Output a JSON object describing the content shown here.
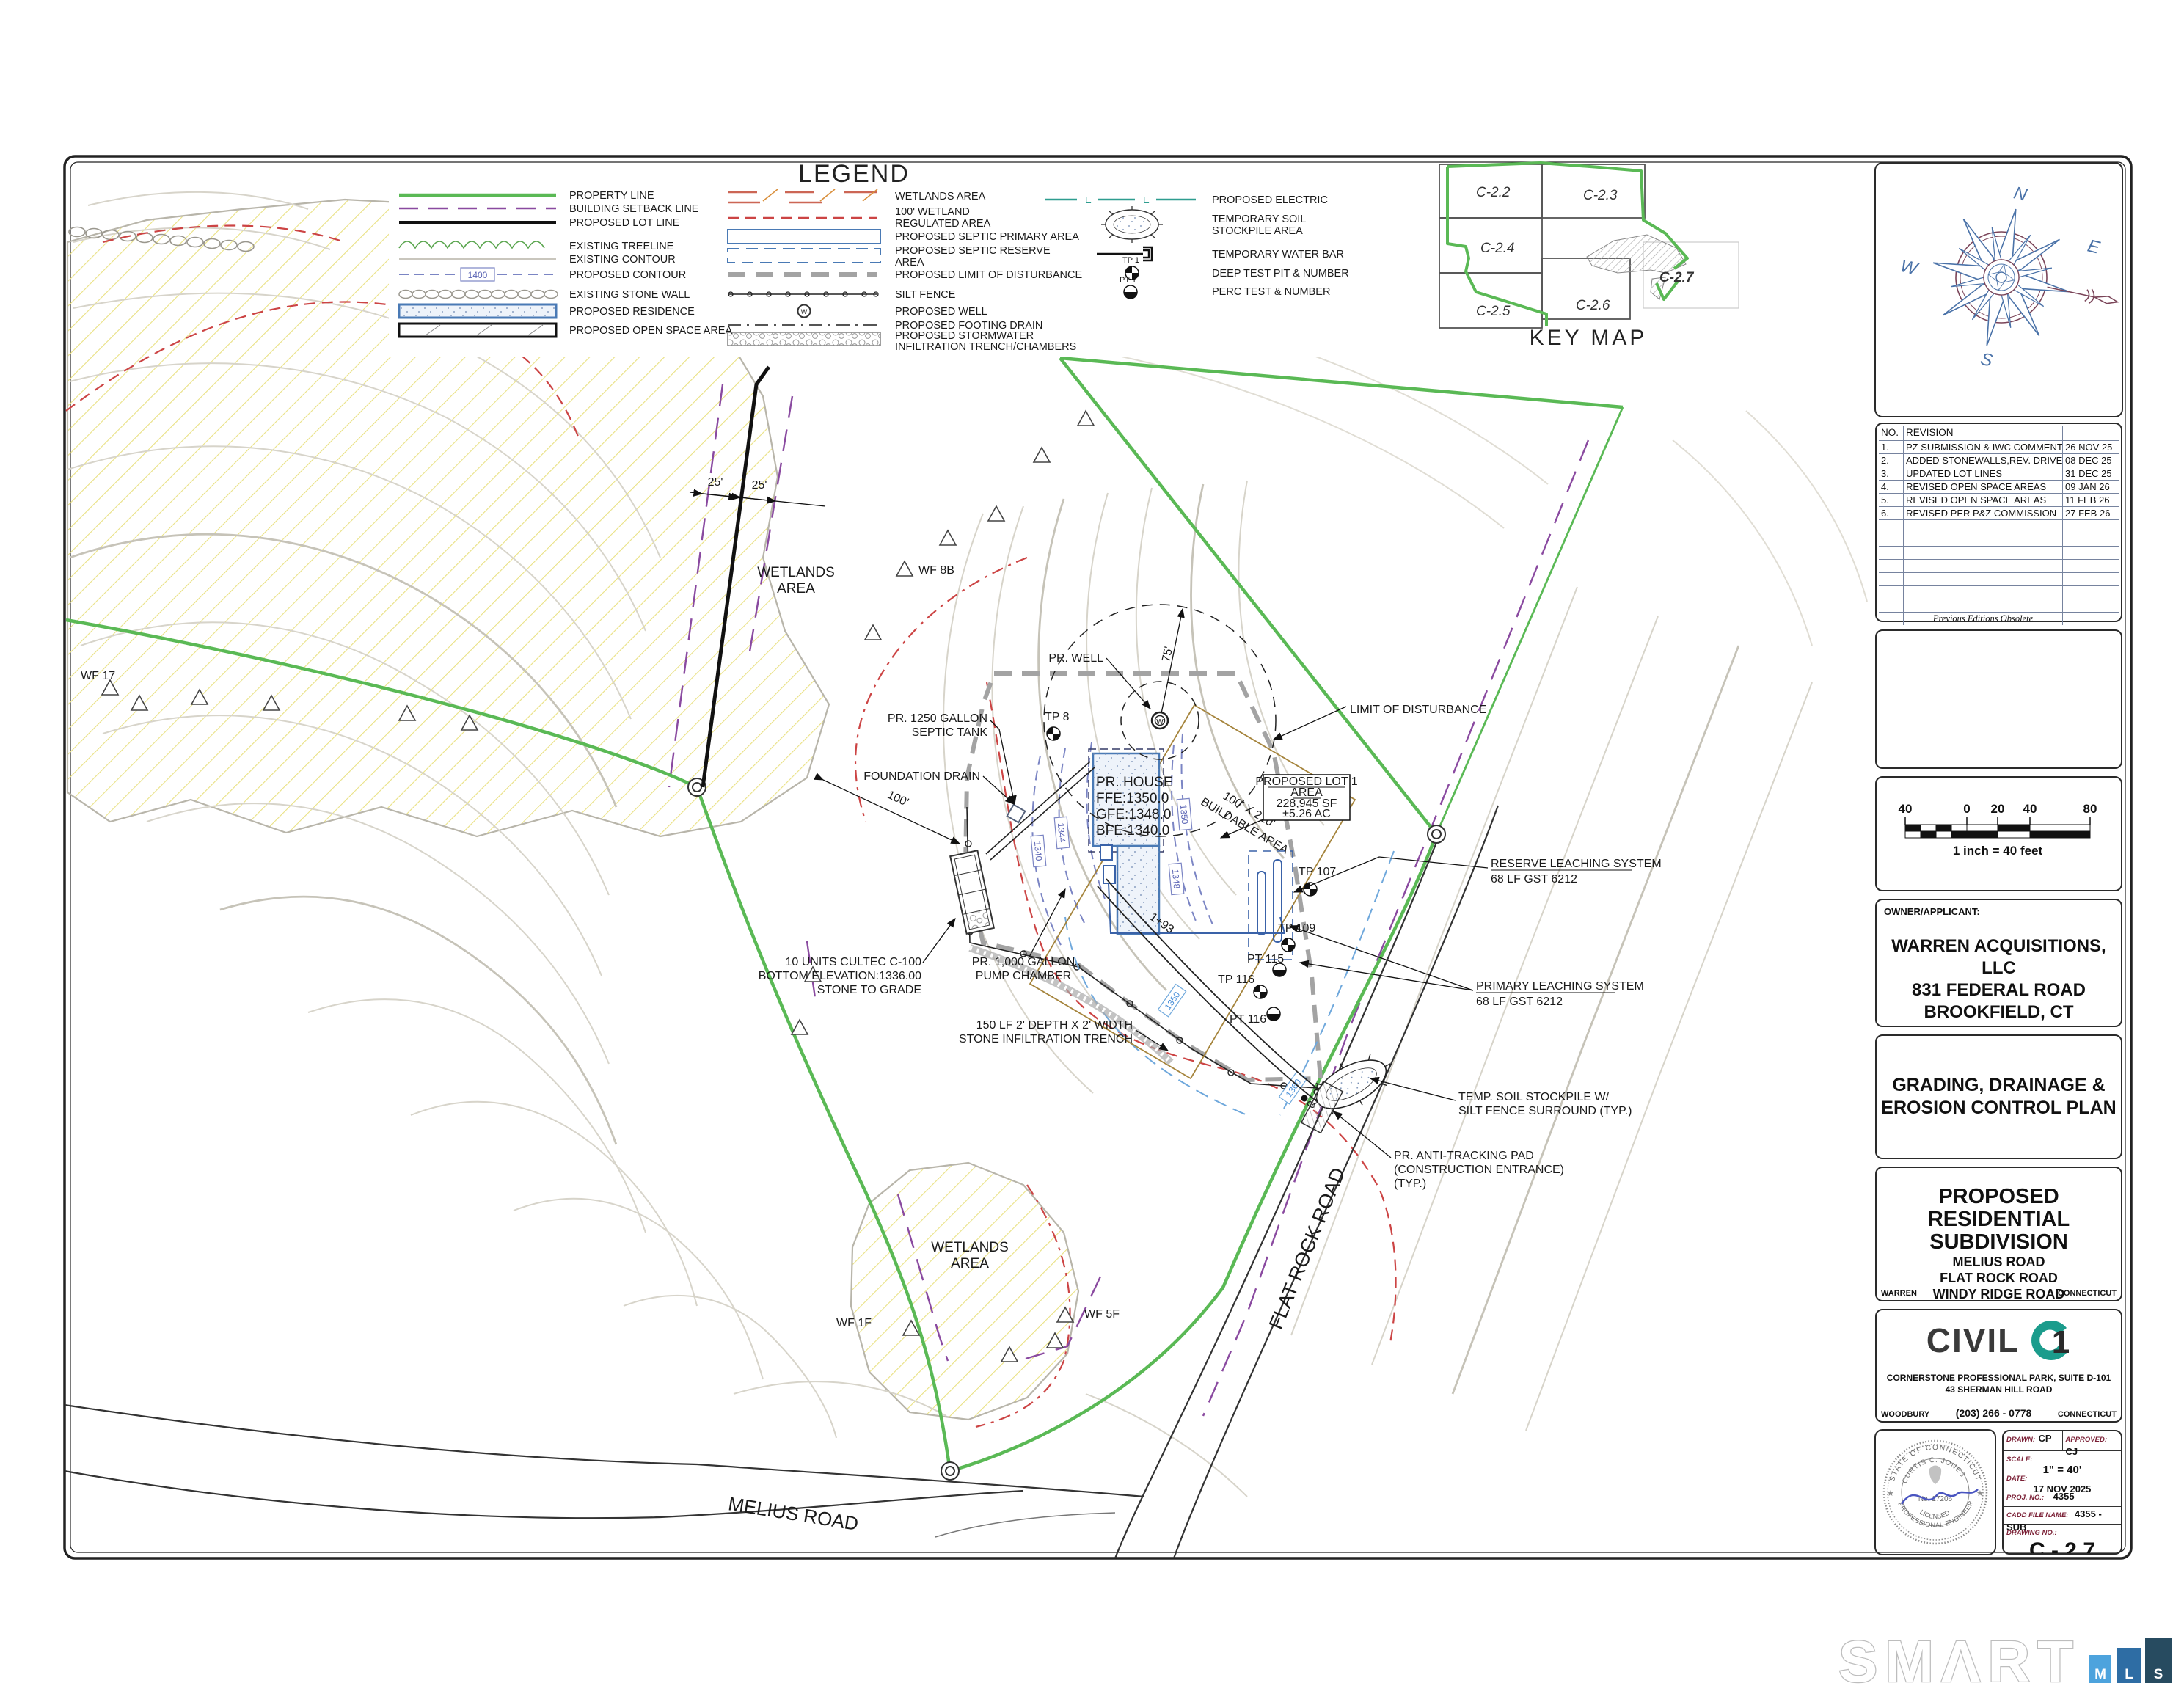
{
  "legend": {
    "title": "LEGEND",
    "col1": [
      "PROPERTY LINE",
      "BUILDING SETBACK LINE",
      "PROPOSED LOT LINE",
      "EXISTING TREELINE",
      "EXISTING CONTOUR",
      "PROPOSED CONTOUR",
      "EXISTING STONE WALL",
      "PROPOSED RESIDENCE",
      "PROPOSED OPEN SPACE AREA"
    ],
    "contour_tag": "1400",
    "col2": [
      [
        "WETLANDS AREA"
      ],
      [
        "100' WETLAND",
        "REGULATED AREA"
      ],
      [
        "PROPOSED SEPTIC PRIMARY AREA"
      ],
      [
        "PROPOSED SEPTIC RESERVE",
        "AREA"
      ],
      [
        "PROPOSED LIMIT OF DISTURBANCE"
      ],
      [
        "SILT FENCE"
      ],
      [
        "PROPOSED WELL"
      ],
      [
        "PROPOSED FOOTING DRAIN"
      ],
      [
        "PROPOSED STORMWATER",
        "INFILTRATION TRENCH/CHAMBERS"
      ]
    ],
    "col3": [
      [
        "PROPOSED ELECTRIC"
      ],
      [
        "TEMPORARY SOIL",
        "STOCKPILE AREA"
      ],
      [
        "TEMPORARY WATER BAR"
      ],
      [
        "DEEP TEST PIT & NUMBER"
      ],
      [
        "PERC TEST & NUMBER"
      ]
    ],
    "electric_letter": "E",
    "well_letter": "W",
    "tp_tag": "TP 1",
    "pt_tag": "PT 1"
  },
  "key_map": {
    "title": "KEY MAP",
    "tiles": [
      "C-2.2",
      "C-2.3",
      "C-2.4",
      "C-2.5",
      "C-2.6"
    ],
    "current": "C-2.7"
  },
  "compass": {
    "n": "N",
    "s": "S",
    "e": "E",
    "w": "W"
  },
  "revisions": {
    "col_no": "NO.",
    "col_rev": "REVISION",
    "rows": [
      {
        "no": "1.",
        "desc": "PZ SUBMISSION & IWC COMMENTS",
        "date": "26 NOV 25"
      },
      {
        "no": "2.",
        "desc": "ADDED STONEWALLS,REV. DRIVEWAYS",
        "date": "08 DEC 25"
      },
      {
        "no": "3.",
        "desc": "UPDATED LOT LINES",
        "date": "31 DEC 25"
      },
      {
        "no": "4.",
        "desc": "REVISED OPEN SPACE AREAS",
        "date": "09 JAN 26"
      },
      {
        "no": "5.",
        "desc": "REVISED OPEN SPACE AREAS",
        "date": "11 FEB 26"
      },
      {
        "no": "6.",
        "desc": "REVISED PER P&Z COMMISSION",
        "date": "27 FEB 26"
      }
    ],
    "footer": "Previous Editions Obsolete"
  },
  "scale_bar": {
    "ticks": [
      "40",
      "0",
      "20",
      "40",
      "80"
    ],
    "caption": "1 inch  = 40 feet"
  },
  "owner": {
    "heading": "OWNER/APPLICANT:",
    "lines": [
      "WARREN ACQUISITIONS, LLC",
      "831 FEDERAL ROAD",
      "BROOKFIELD, CT"
    ]
  },
  "plan_title": {
    "line1": "GRADING, DRAINAGE  &",
    "line2": "EROSION CONTROL PLAN"
  },
  "project": {
    "line1": "PROPOSED RESIDENTIAL",
    "line2": "SUBDIVISION",
    "roads": [
      "MELIUS ROAD",
      "FLAT ROCK ROAD",
      "WINDY RIDGE ROAD"
    ],
    "town": "WARREN",
    "state": "CONNECTICUT"
  },
  "firm": {
    "brand_word": "CIVIL",
    "brand_num": "1",
    "addr1": "CORNERSTONE PROFESSIONAL PARK, SUITE D-101",
    "addr2": "43 SHERMAN HILL ROAD",
    "phone": "(203) 266 - 0778",
    "town": "WOODBURY",
    "state": "CONNECTICUT"
  },
  "seal": {
    "arc_top": "STATE OF CONNECTICUT",
    "name": "CURTIS C. JONES",
    "number": "No. 17206",
    "licensed": "LICENSED",
    "profession": "PROFESSIONAL ENGINEER"
  },
  "title_block": {
    "drawn_label": "DRAWN:",
    "drawn": "CP",
    "approved_label": "APPROVED:",
    "approved": "CJ",
    "scale_label": "SCALE:",
    "scale": "1\" = 40'",
    "date_label": "DATE:",
    "date": "17 NOV 2025",
    "proj_label": "PROJ. NO.:",
    "proj": "4355",
    "cadd_label": "CADD FILE NAME:",
    "cadd": "4355 - SUB",
    "drawing_label": "DRAWING NO.:",
    "drawing_no": "C - 2.7"
  },
  "map": {
    "wetlands": [
      "WETLANDS",
      "AREA"
    ],
    "pr_well": "PR. WELL",
    "radius_75": "75'",
    "lod": "LIMIT OF DISTURBANCE",
    "septic_tank": [
      "PR. 1250 GALLON",
      "SEPTIC TANK"
    ],
    "foundation_drain": "FOUNDATION DRAIN",
    "house": [
      "PR. HOUSE",
      "FFE:1350.0",
      "GFE:1348.0",
      "BFE:1340.0"
    ],
    "lot": [
      "PROPOSED LOT 1",
      "AREA",
      "228,945 SF",
      "±5.26 AC"
    ],
    "buildable": [
      "100' X 210'",
      "BUILDABLE AREA"
    ],
    "reserve": [
      "RESERVE LEACHING SYSTEM",
      "68 LF GST 6212"
    ],
    "primary": [
      "PRIMARY LEACHING SYSTEM",
      "68 LF GST 6212"
    ],
    "cultec": [
      "10 UNITS CULTEC C-100",
      "BOTTOM ELEVATION:1336.00",
      "STONE TO GRADE"
    ],
    "pump": [
      "PR. 1,000 GALLON",
      "PUMP CHAMBER"
    ],
    "trench": [
      "150 LF 2' DEPTH X 2' WIDTH",
      "STONE INFILTRATION TRENCH"
    ],
    "stockpile": [
      "TEMP. SOIL STOCKPILE W/",
      "SILT FENCE SURROUND (TYP.)"
    ],
    "antitracking": [
      "PR. ANTI-TRACKING PAD",
      "(CONSTRUCTION ENTRANCE)",
      "(TYP.)"
    ],
    "roads": {
      "flat_rock": "FLAT ROCK ROAD",
      "melius": "MELIUS ROAD"
    },
    "dims": {
      "d25": "25'",
      "d100": "100'"
    },
    "stations": {
      "s193": "1+93",
      "s000": "0+00"
    },
    "flags": {
      "wf17": "WF 17",
      "wf8b": "WF 8B",
      "wf1f": "WF 1F",
      "wf5f": "WF 5F"
    },
    "testpits": {
      "tp8": "TP 8",
      "tp107": "TP 107",
      "tp109": "TP 109",
      "pt115": "PT 115",
      "tp116": "TP 116",
      "pt116": "PT 116"
    },
    "contour_tags": {
      "c1340": "1340",
      "c1344": "1344",
      "c1348": "1348",
      "c1350": "1350",
      "c1360": "1360"
    }
  },
  "watermark": {
    "word": "SMART",
    "word_stylized": "SMΛRT",
    "tiles": [
      "M",
      "L",
      "S"
    ]
  }
}
